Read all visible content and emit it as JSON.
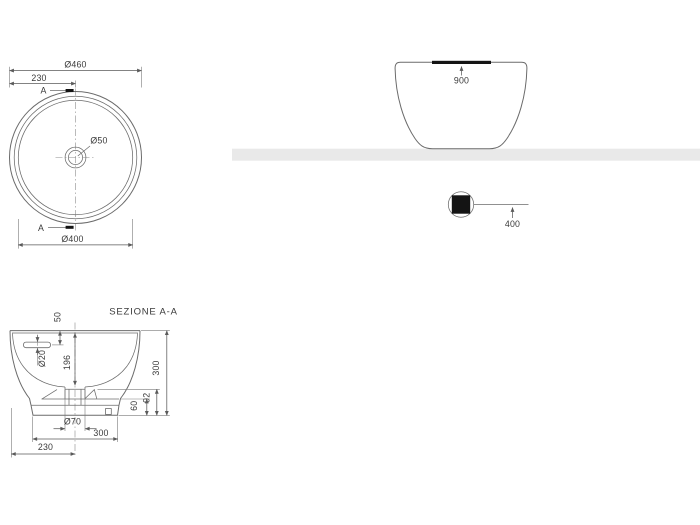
{
  "drawing": {
    "plan_view": {
      "outer_diameter": "Ø460",
      "center_offset": "230",
      "drain_diameter": "Ø50",
      "inner_diameter": "Ø400",
      "section_marker_top": "A",
      "section_marker_bottom": "A"
    },
    "front_view": {
      "rim_height": "900",
      "outlet_height": "400"
    },
    "section_view": {
      "title": "SEZIONE A-A",
      "rim_to_overflow": "50",
      "overflow_diameter": "Ø20",
      "bowl_depth": "196",
      "overall_height": "300",
      "outlet_height": "92",
      "base_height": "60",
      "drain_hole_diameter": "Ø70",
      "base_width": "300",
      "edge_to_center": "230"
    },
    "colors": {
      "line": "#6b6b6b",
      "dim": "#5a5a5a",
      "text": "#3a3a3a",
      "solid": "#141414",
      "band": "#e9e9e9",
      "bg": "#ffffff"
    }
  }
}
